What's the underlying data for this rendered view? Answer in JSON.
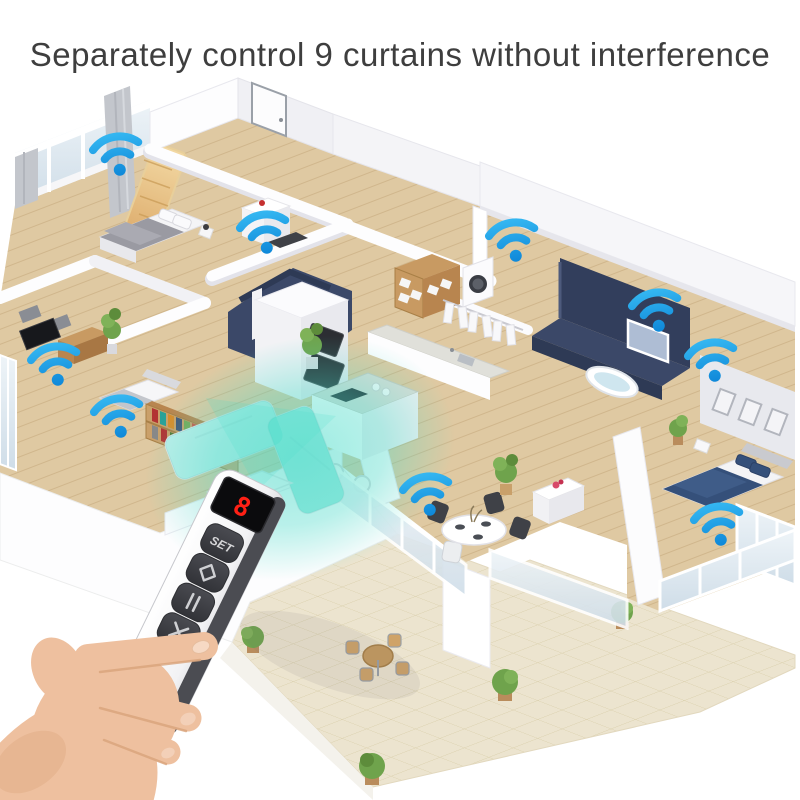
{
  "title": "Separately control 9 curtains without interference",
  "wifi": {
    "count": 9,
    "color_top": "#35b8f2",
    "color_bottom": "#0d86d8",
    "points": [
      {
        "x": 117,
        "y": 154,
        "rot": -10
      },
      {
        "x": 264,
        "y": 232,
        "rot": -10
      },
      {
        "x": 513,
        "y": 240,
        "rot": -10
      },
      {
        "x": 656,
        "y": 310,
        "rot": -10
      },
      {
        "x": 712,
        "y": 360,
        "rot": -10
      },
      {
        "x": 55,
        "y": 364,
        "rot": -10
      },
      {
        "x": 118,
        "y": 416,
        "rot": -10
      },
      {
        "x": 427,
        "y": 494,
        "rot": -10
      },
      {
        "x": 718,
        "y": 524,
        "rot": -10
      }
    ]
  },
  "beam": {
    "color": "#3fd8c8"
  },
  "remote": {
    "display_value": "8",
    "set_label": "SET",
    "display_color": "#ff2015",
    "buttons": [
      {
        "name": "set-button",
        "type": "text",
        "label": "SET"
      },
      {
        "name": "open-button",
        "type": "icon",
        "icon": "diamond-open-icon"
      },
      {
        "name": "pause-button",
        "type": "icon",
        "icon": "pause-icon"
      },
      {
        "name": "close-button",
        "type": "icon",
        "icon": "x-close-icon"
      }
    ]
  },
  "palette": {
    "wood": "#dfc9a2",
    "wood_line": "#d0b68c",
    "tile": "#ece4cf",
    "tile_line": "#d8cda8",
    "navy": "#3b4868",
    "navy_dark": "#2e3a55",
    "wall": "#ffffff",
    "wall_shade": "#e9e9ef",
    "sofa_teal": "#49dcc9",
    "accent_red": "#c53030",
    "plant_green": "#6fa34c",
    "skin": "#eec09f",
    "skin_shade": "#d9a47c"
  }
}
